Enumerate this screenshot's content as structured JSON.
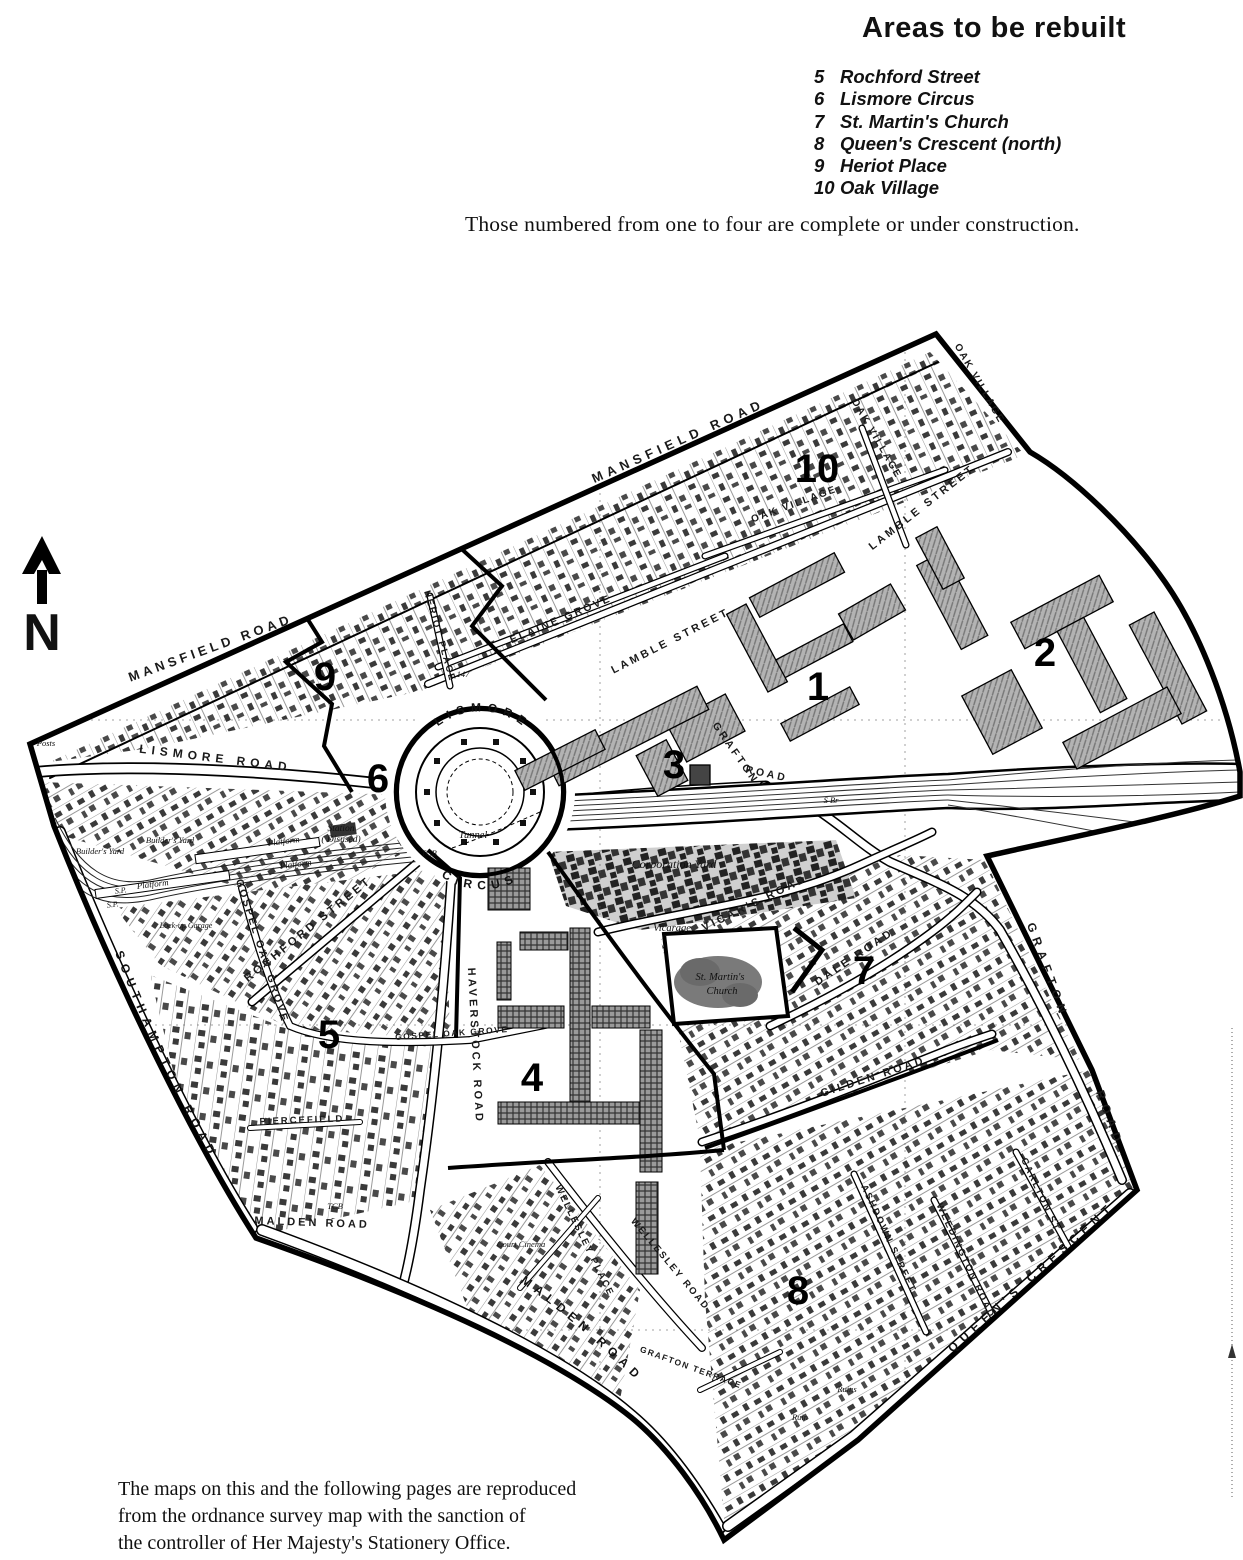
{
  "header": {
    "title": "Areas to be rebuilt",
    "note": "Those numbered from one to four are complete or under construction."
  },
  "legend": {
    "items": [
      {
        "num": "5",
        "label": "Rochford Street"
      },
      {
        "num": "6",
        "label": "Lismore Circus"
      },
      {
        "num": "7",
        "label": "St. Martin's Church"
      },
      {
        "num": "8",
        "label": "Queen's Crescent (north)"
      },
      {
        "num": "9",
        "label": "Heriot Place"
      },
      {
        "num": "10",
        "label": "Oak Village"
      }
    ]
  },
  "compass": {
    "label": "N"
  },
  "map": {
    "area_numbers": [
      {
        "n": "1"
      },
      {
        "n": "2"
      },
      {
        "n": "3"
      },
      {
        "n": "4"
      },
      {
        "n": "5"
      },
      {
        "n": "6"
      },
      {
        "n": "7"
      },
      {
        "n": "8"
      },
      {
        "n": "9"
      },
      {
        "n": "10"
      }
    ],
    "streets": [
      {
        "text": "MANSFIELD ROAD"
      },
      {
        "text": "MANSFIELD ROAD"
      },
      {
        "text": "LISMORE ROAD"
      },
      {
        "text": "LAMBLE STREET"
      },
      {
        "text": "LAMBLE STREET"
      },
      {
        "text": "OAK VILLAGE"
      },
      {
        "text": "OAK VILLAGE"
      },
      {
        "text": "OAK VILLAGE"
      },
      {
        "text": "ELAINE GROVE"
      },
      {
        "text": "HERIOT PLACE"
      },
      {
        "text": "ROCHFORD STREET"
      },
      {
        "text": "GOSPEL OAK GROVE"
      },
      {
        "text": "GOSPEL OAK GROVE"
      },
      {
        "text": "HAVERSTOCK ROAD"
      },
      {
        "text": "GRAFTON"
      },
      {
        "text": "ROAD"
      },
      {
        "text": "GRAFTON"
      },
      {
        "text": "ROAD"
      },
      {
        "text": "VICAR'S ROAD"
      },
      {
        "text": "DALE ROAD"
      },
      {
        "text": "GILDEN ROAD"
      },
      {
        "text": "ASHDOWN STREET"
      },
      {
        "text": "WEEDINGTON ROAD"
      },
      {
        "text": "CARLTON ST"
      },
      {
        "text": "WELLESLEY PLACE"
      },
      {
        "text": "WELLESLEY ROAD"
      },
      {
        "text": "GRAFTON TERRACE"
      },
      {
        "text": "MALDEN ROAD"
      },
      {
        "text": "PIERCEFIELD"
      }
    ],
    "curved_streets": {
      "lismore": "LISMORE",
      "circus": "CIRCUS",
      "southampton": "SOUTHAMPTON ROAD",
      "malden": "MALDEN ROAD",
      "queens": "QUEEN'S CRESCENT"
    },
    "places": [
      {
        "text": "Corporation Yard"
      },
      {
        "text": "Vicarage"
      },
      {
        "text": "St. Martin's"
      },
      {
        "text": "Church"
      },
      {
        "text": "Tunnel"
      },
      {
        "text": "Station"
      },
      {
        "text": "( Disused)"
      },
      {
        "text": "Platform"
      },
      {
        "text": "Platform"
      },
      {
        "text": "Platform"
      },
      {
        "text": "Builder's Yard"
      },
      {
        "text": "Builder's Yard"
      },
      {
        "text": "Posts"
      },
      {
        "text": "Lock-up Garage"
      },
      {
        "text": "Court Cinema"
      },
      {
        "text": "Ruin"
      },
      {
        "text": "Ruins"
      },
      {
        "text": "TCB"
      },
      {
        "text": "TCB"
      },
      {
        "text": "S Br"
      },
      {
        "text": "147"
      },
      {
        "text": "S.P."
      },
      {
        "text": "S.P."
      }
    ]
  },
  "footer": {
    "lines": [
      "The maps on this and the following pages are reproduced",
      "from the ordnance survey map with the sanction of",
      "the controller of Her Majesty's Stationery Office."
    ]
  },
  "colors": {
    "ink": "#111111",
    "paper": "#ffffff"
  }
}
